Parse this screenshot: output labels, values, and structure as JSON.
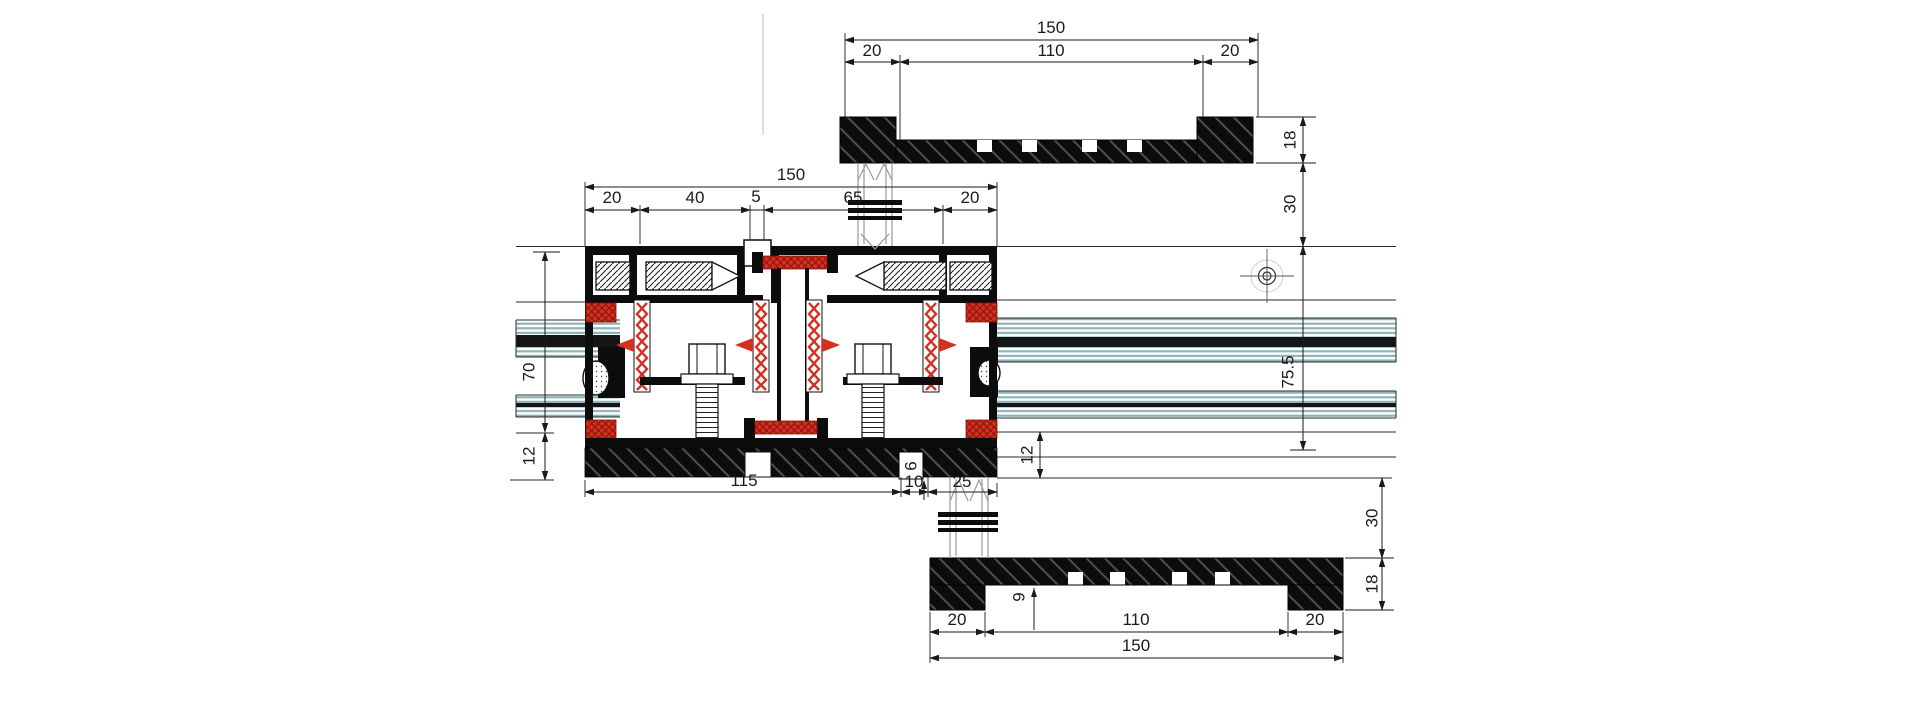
{
  "document": {
    "type": "technical-drawing",
    "subject": "aluminium curtain wall / sliding door profile horizontal cross-section"
  },
  "colors": {
    "profile_black": "#0c0c0c",
    "hatch_line": "#4f4f4f",
    "gasket_red": "#d23122",
    "glass_teal": "#8fb3b7",
    "dim_line": "#1a1a1a",
    "centerline_gray": "#bdbdbd"
  },
  "dims": {
    "top_cap": {
      "total": "150",
      "left": "20",
      "middle": "110",
      "right": "20",
      "height": "18",
      "gap": "30"
    },
    "glazing": {
      "axis": "75.5"
    },
    "mullion": {
      "total": "150",
      "s1": "20",
      "s2": "40",
      "s3": "5",
      "s4": "65",
      "s5": "20",
      "depth": "70",
      "h_left": "12",
      "h_right": "12",
      "base": "115",
      "step": "10",
      "channel": "25",
      "notch": "6"
    },
    "bottom_cap": {
      "recess": "9",
      "left": "20",
      "middle": "110",
      "right": "20",
      "total": "150",
      "gap": "30",
      "height": "18"
    }
  }
}
